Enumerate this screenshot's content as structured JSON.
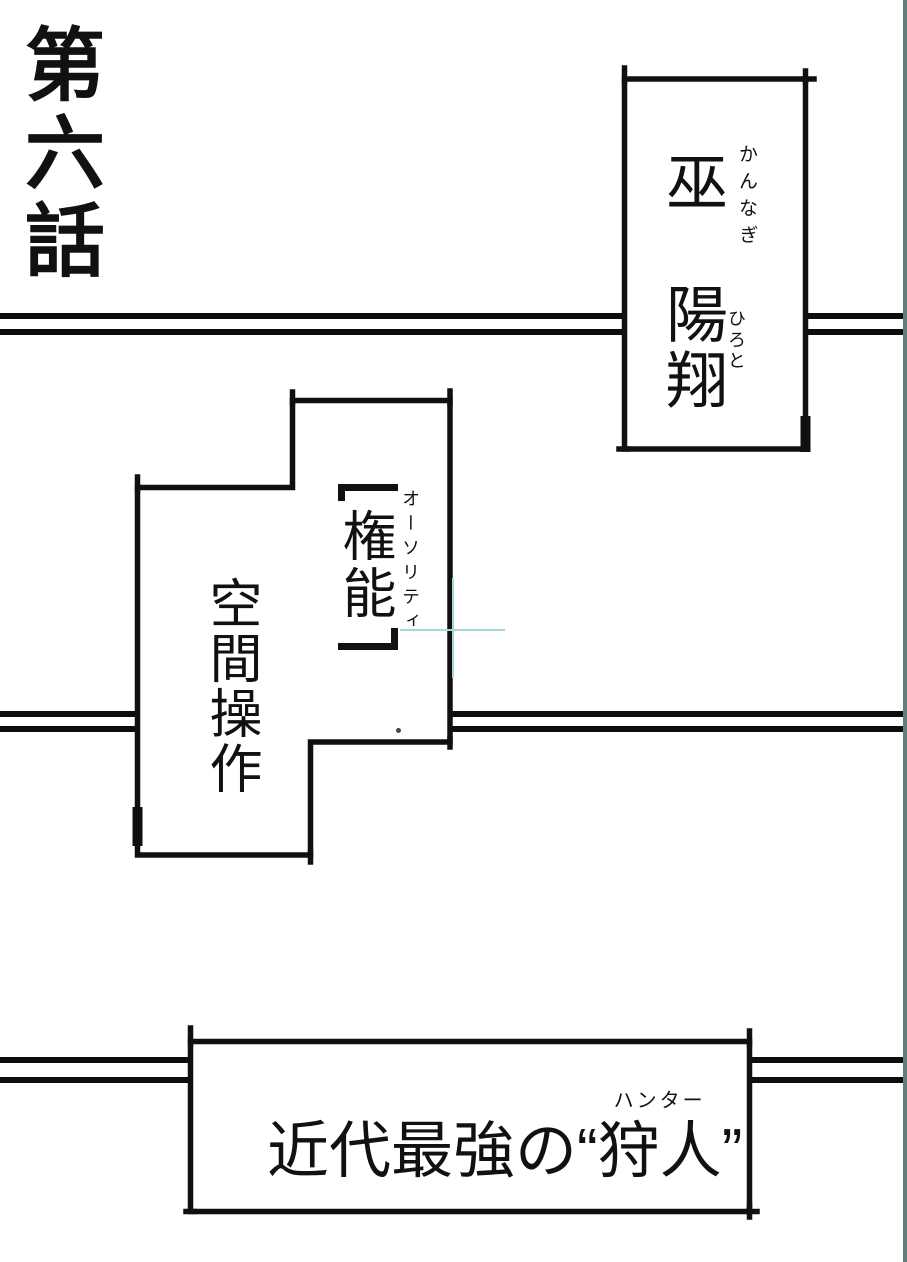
{
  "page": {
    "episode_title": "第六話",
    "ink_color": "#111111",
    "edge_strip_color": "#5f7f7f",
    "crosshair_color": "#a9d6da"
  },
  "character_box": {
    "name": "巫　陽翔",
    "surname_furigana": "かんなぎ",
    "given_name_furigana": "ひろと"
  },
  "authority_box": {
    "bracket_open": "「",
    "title": "権能",
    "bracket_close": "」",
    "title_furigana": "オーソリティ",
    "subtitle": "空間操作"
  },
  "hunter_box": {
    "prefix": "近代最強の",
    "quote_open": "“",
    "word": "狩人",
    "word_furigana": "ハンター",
    "quote_close": "”"
  }
}
